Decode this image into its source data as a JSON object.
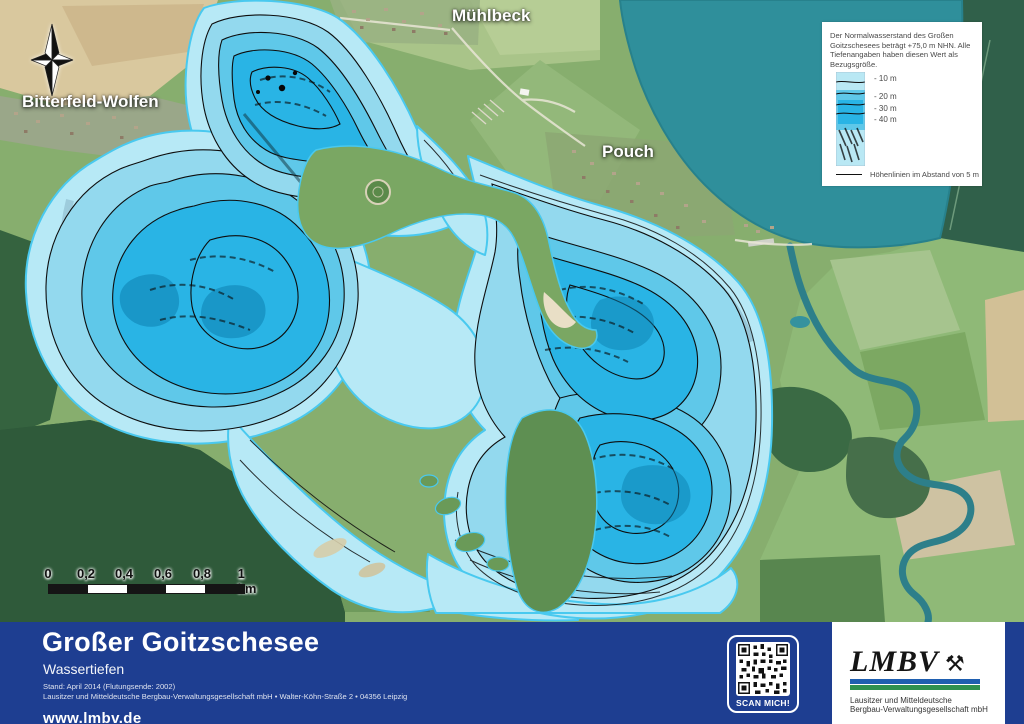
{
  "map": {
    "place_labels": {
      "muehlbeck": "Mühlbeck",
      "bitterfeld_wolfen": "Bitterfeld-Wolfen",
      "pouch": "Pouch"
    }
  },
  "legend": {
    "note": "Der Normalwasserstand des Großen Goitzschesees beträgt +75,0 m NHN. Alle Tiefenangaben haben diesen Wert als Bezugsgröße.",
    "depths": [
      "- 10 m",
      "- 20 m",
      "- 30 m",
      "- 40 m"
    ],
    "contour_note": "Höhenlinien im Abstand von 5 m"
  },
  "scalebar": {
    "ticks": [
      "0",
      "0,2",
      "0,4",
      "0,6",
      "0,8",
      "1 km"
    ]
  },
  "footer": {
    "title": "Großer Goitzschesee",
    "subtitle": "Wassertiefen",
    "meta_line1": "Stand: April 2014 (Flutungsende: 2002)",
    "meta_line2": "Lausitzer und Mitteldeutsche Bergbau-Verwaltungsgesellschaft mbH • Walter-Köhn-Straße 2 • 04356 Leipzig",
    "website": "www.lmbv.de",
    "qr_label": "SCAN MICH!",
    "logo": {
      "wordmark": "LMBV",
      "subline1": "Lausitzer und Mitteldeutsche",
      "subline2": "Bergbau-Verwaltungsgesellschaft mbH"
    }
  },
  "colors": {
    "footer_background": "#1e3e91",
    "water_shallow": "#b7e9f6",
    "water_mid": "#5fc8e9",
    "water_deep": "#29b4e5",
    "natural_lake_teal": "#2f8f9b",
    "contour_line": "#0d0d0d",
    "logo_blue": "#1f5fb0",
    "logo_green": "#2f9150"
  }
}
